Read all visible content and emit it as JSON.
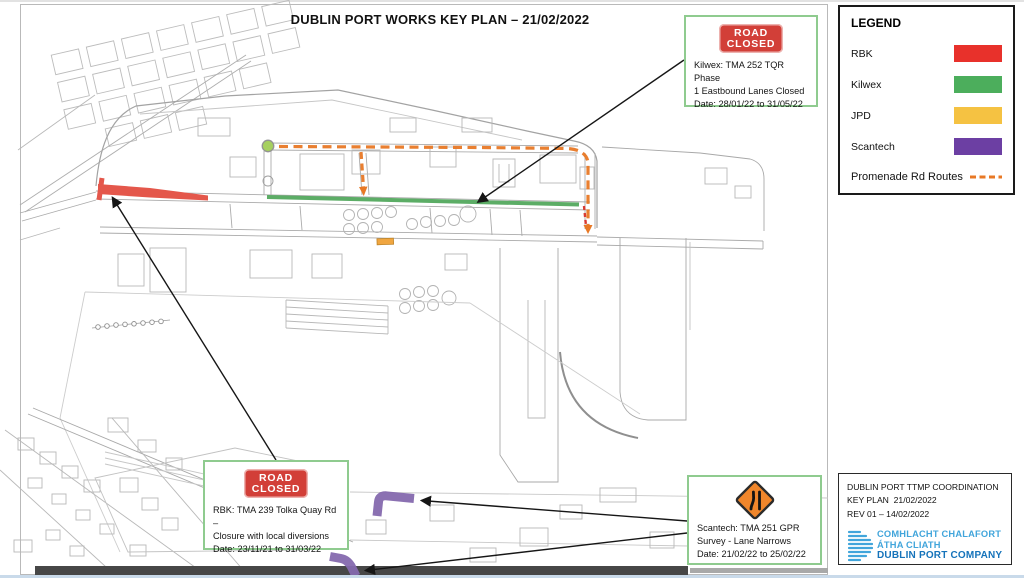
{
  "title": "DUBLIN PORT WORKS KEY PLAN – 21/02/2022",
  "legend": {
    "heading": "LEGEND",
    "items": [
      {
        "label": "RBK",
        "color": "#e8312b"
      },
      {
        "label": "Kilwex",
        "color": "#4cae5c"
      },
      {
        "label": "JPD",
        "color": "#f5c242"
      },
      {
        "label": "Scantech",
        "color": "#6c3fa3"
      }
    ],
    "route_item": {
      "label": "Promenade Rd Routes",
      "color": "#e87825"
    }
  },
  "callouts": {
    "kilwex": {
      "sign_line1": "ROAD",
      "sign_line2": "CLOSED",
      "lines": [
        "Kilwex: TMA 252 TQR Phase",
        "1 Eastbound Lanes Closed",
        "Date: 28/01/22 to 31/05/22"
      ]
    },
    "rbk": {
      "sign_line1": "ROAD",
      "sign_line2": "CLOSED",
      "lines": [
        "RBK: TMA 239 Tolka Quay Rd –",
        "Closure with local diversions",
        "Date: 23/11/21 to 31/03/22"
      ]
    },
    "scantech": {
      "sign": "lane-narrows-roadworks",
      "lines": [
        "Scantech: TMA 251 GPR",
        "Survey - Lane Narrows",
        "Date: 21/02/22 to 25/02/22"
      ]
    }
  },
  "info_box": {
    "lines": [
      "DUBLIN PORT TTMP COORDINATION",
      "KEY PLAN  21/02/2022",
      "REV 01 – 14/02/2022"
    ],
    "logo_line1": "COMHLACHT CHALAFORT",
    "logo_line2": "ÁTHA CLIATH",
    "logo_line3": "DUBLIN PORT COMPANY"
  },
  "map_colors": {
    "rbk_route": "#e4574b",
    "kilwex_route": "#4fa75a",
    "jpd_route": "#f0a640",
    "scantech_route": "#8569ae",
    "promenade_route": "#e87825",
    "road_closed_sign_red": "#d23f38",
    "callout_border_green": "#8fcb8f",
    "roundabout_green": "#a6d05f",
    "logo_light_blue": "#41a5db",
    "logo_dark_blue": "#1573ba"
  }
}
